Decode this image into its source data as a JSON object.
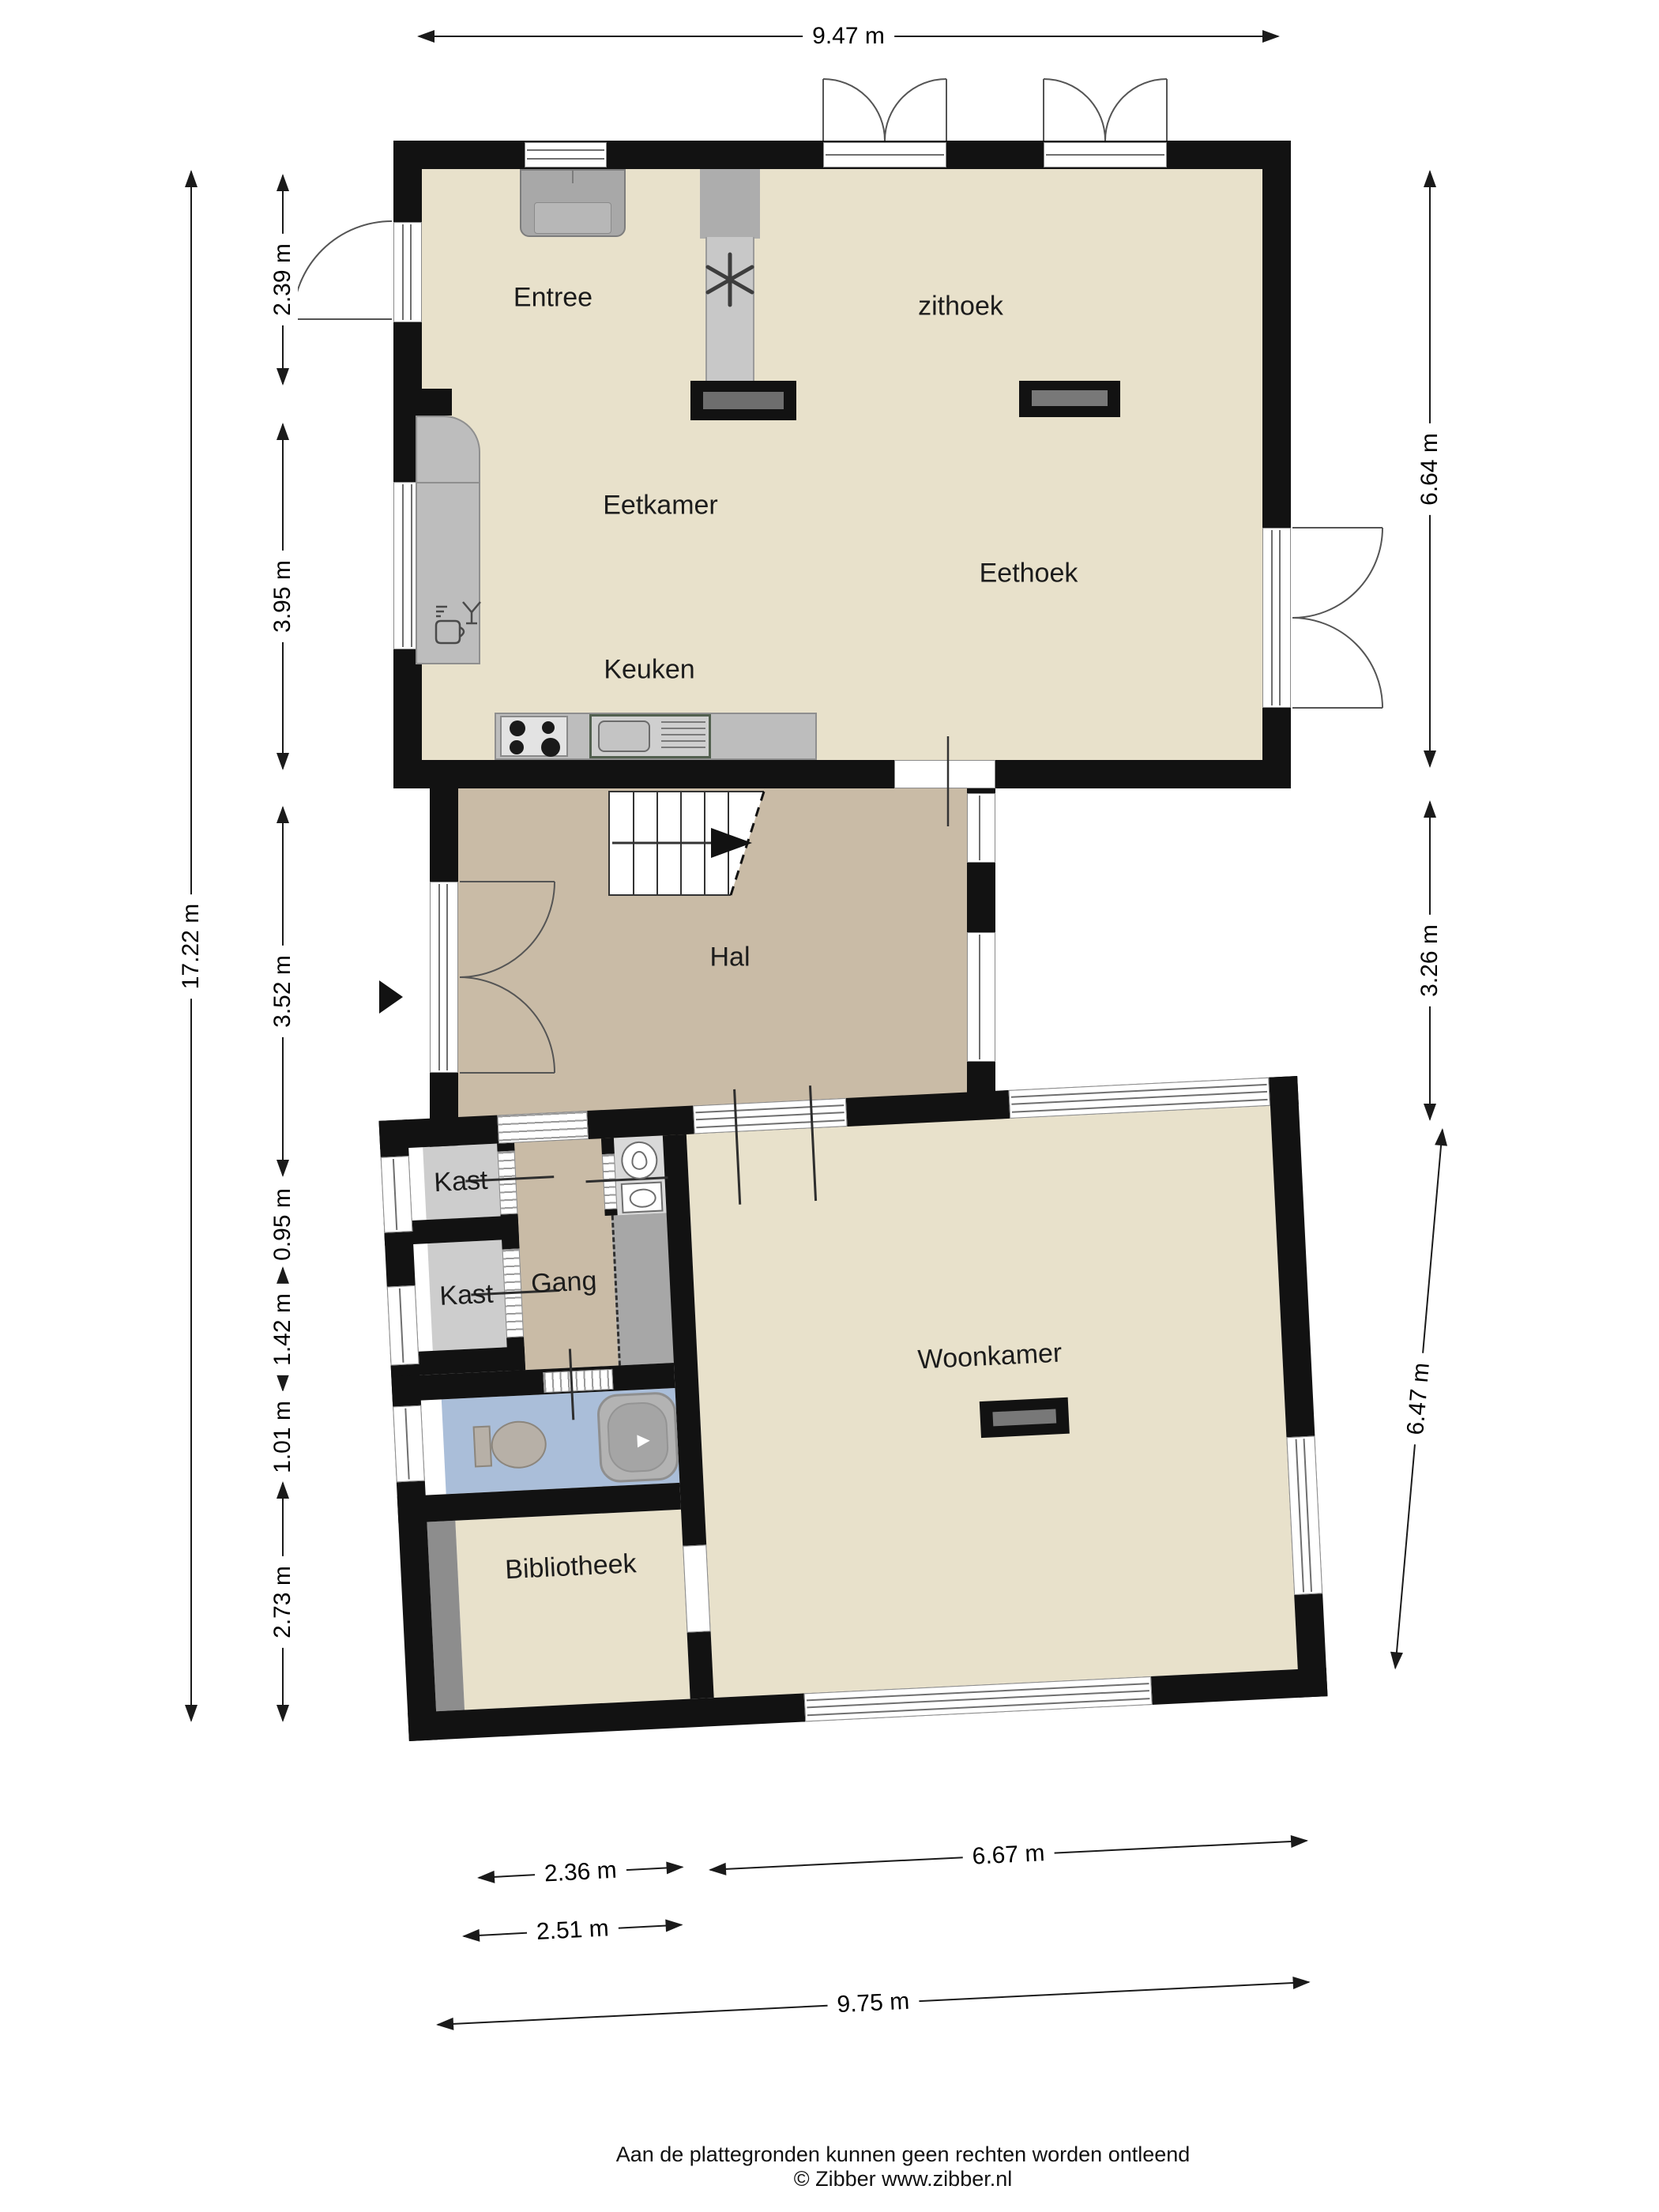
{
  "floorplan": {
    "rooms": {
      "entree": "Entree",
      "zithoek": "zithoek",
      "eetkamer": "Eetkamer",
      "eethoek": "Eethoek",
      "keuken": "Keuken",
      "hal": "Hal",
      "kast_1": "Kast",
      "kast_2": "Kast",
      "gang": "Gang",
      "woonkamer": "Woonkamer",
      "bibliotheek": "Bibliotheek"
    },
    "dimensions": {
      "top": "9.47 m",
      "left_overall": "17.22 m",
      "left": [
        "2.39 m",
        "3.95 m",
        "3.52 m",
        "0.95 m",
        "1.42 m",
        "1.01 m",
        "2.73 m"
      ],
      "right": [
        "6.64 m",
        "3.26 m",
        "6.47 m"
      ],
      "bottom": [
        "2.36 m",
        "6.67 m",
        "2.51 m",
        "9.75 m"
      ]
    },
    "footer": {
      "line1": "Aan de plattegronden kunnen geen rechten worden ontleend",
      "line2": "© Zibber www.zibber.nl"
    },
    "colors": {
      "wall": "#121212",
      "floor_main": "#e8e1cb",
      "floor_hall": "#c9bba6",
      "floor_closet": "#cdcdcd",
      "floor_wc": "#d9d9d9",
      "floor_void": "#a7a7a7",
      "floor_bath": "#aabed9",
      "floor_strip": "#8d8d8d",
      "furniture_grey": "#bdbdbd"
    }
  }
}
